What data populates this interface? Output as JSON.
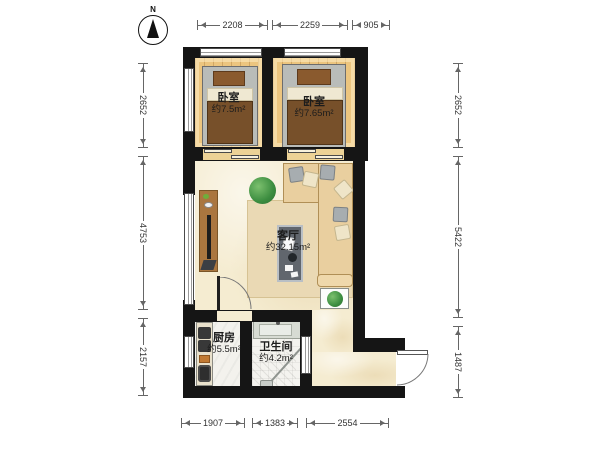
{
  "north_label": "N",
  "rooms": {
    "bedroom_left": {
      "name": "卧室",
      "area": "约7.5m²"
    },
    "bedroom_right": {
      "name": "卧室",
      "area": "约7.65m²"
    },
    "living_room": {
      "name": "客厅",
      "area": "约32.15m²"
    },
    "kitchen": {
      "name": "厨房",
      "area": "约5.5m²"
    },
    "bathroom": {
      "name": "卫生间",
      "area": "约4.2m²"
    }
  },
  "dimensions_mm": {
    "top": [
      "2208",
      "2259",
      "905"
    ],
    "bottom": [
      "1907",
      "1383",
      "2554"
    ],
    "left": [
      "2652",
      "4753",
      "2157"
    ],
    "right": [
      "2652",
      "5422",
      "1487"
    ]
  },
  "colors": {
    "wall": "#151515",
    "wood_floor": "#ecc57f",
    "marble_floor": "#f5ecd1",
    "tile_floor": "#f3f2ed",
    "bed_blanket": "#77502a",
    "sofa": "#e9cf9f",
    "plant": "#3c8d40"
  }
}
